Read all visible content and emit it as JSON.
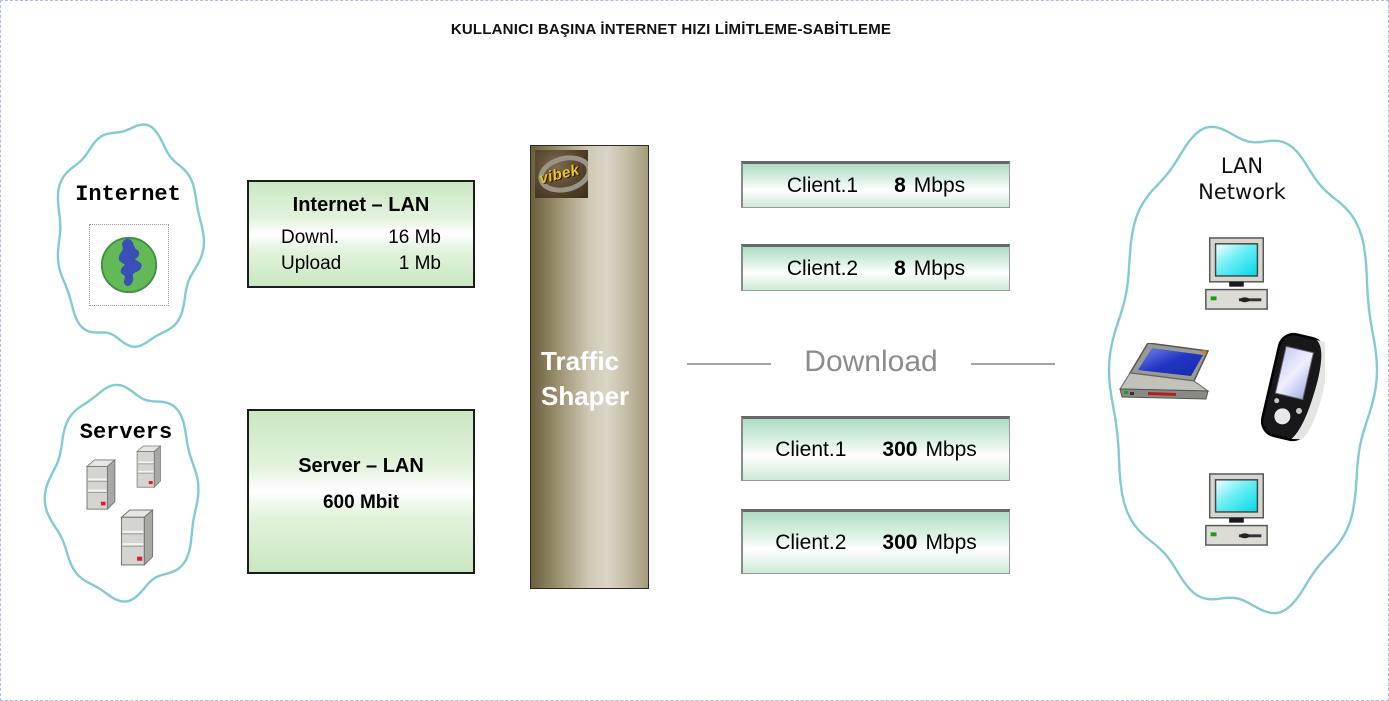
{
  "page": {
    "title": "KULLANICI BAŞINA İNTERNET HIZI LİMİTLEME-SABİTLEME"
  },
  "internet_cloud": {
    "label": "Internet"
  },
  "servers_cloud": {
    "label": "Servers"
  },
  "internet_lan_box": {
    "title": "Internet – LAN",
    "rows": [
      {
        "label": "Downl.",
        "value": "16 Mb"
      },
      {
        "label": "Upload",
        "value": "1 Mb"
      }
    ]
  },
  "server_lan_box": {
    "title": "Server – LAN",
    "bandwidth": "600 Mbit"
  },
  "traffic_shaper": {
    "logo": "vibek",
    "line1": "Traffic",
    "line2": "Shaper"
  },
  "divider": {
    "label": "Download"
  },
  "clients_top": [
    {
      "name": "Client.1",
      "value": "8",
      "unit": "Mbps"
    },
    {
      "name": "Client.2",
      "value": "8",
      "unit": "Mbps"
    }
  ],
  "clients_bottom": [
    {
      "name": "Client.1",
      "value": "300",
      "unit": "Mbps"
    },
    {
      "name": "Client.2",
      "value": "300",
      "unit": "Mbps"
    }
  ],
  "lan_cloud": {
    "line1": "LAN",
    "line2": "Network"
  },
  "colors": {
    "cloud_stroke": "#82cbd6",
    "box_green": "#d9efd2",
    "bar_green": "#bfe3cc",
    "shaper_dark": "#6a5f3e",
    "shaper_light": "#dad5c6",
    "download_text": "#8c8c8c",
    "logo_text": "#f2c41e",
    "page_border": "#aebce6"
  }
}
